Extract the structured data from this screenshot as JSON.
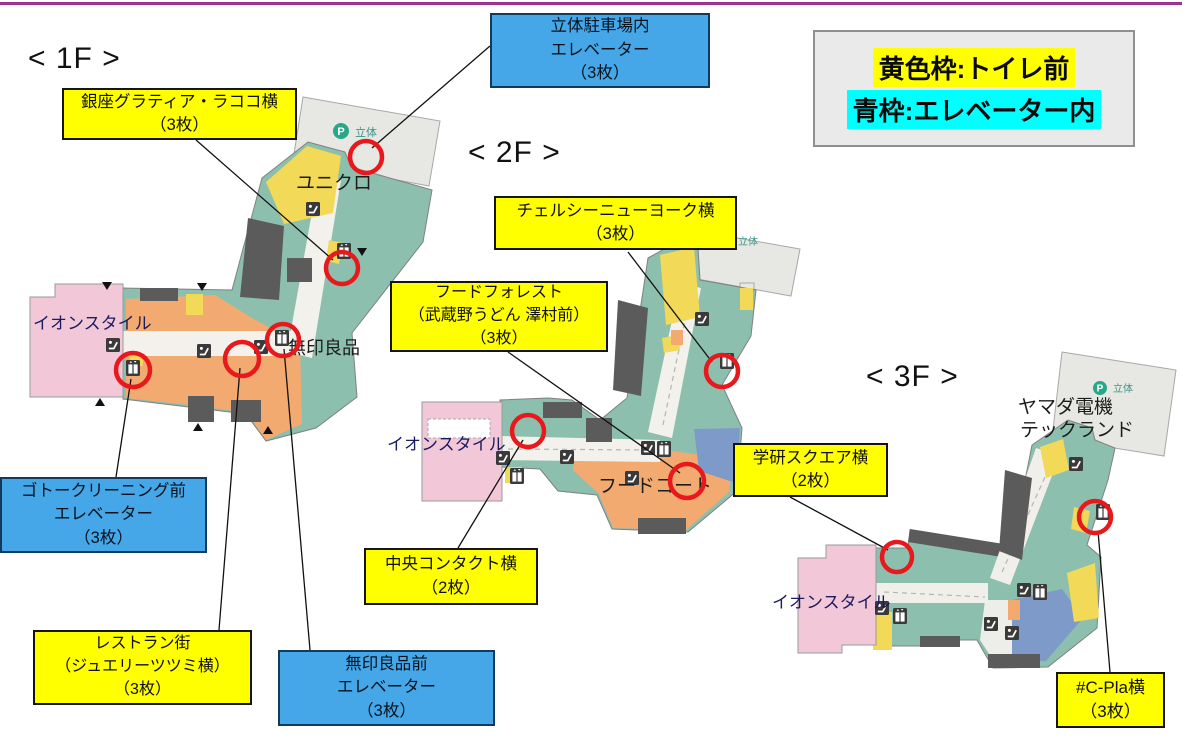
{
  "legend": {
    "line1": "黄色枠:トイレ前",
    "line2": "青枠:エレベーター内",
    "yellow": "#ffff00",
    "cyan": "#00ffff"
  },
  "floors": {
    "f1": "< 1F >",
    "f2": "< 2F >",
    "f3": "< 3F >"
  },
  "callouts": {
    "ginza": {
      "lines": [
        "銀座グラティア・ラココ横",
        "（3枚）"
      ]
    },
    "parking_ev": {
      "lines": [
        "立体駐車場内",
        "エレベーター",
        "（3枚）"
      ]
    },
    "chelsea": {
      "lines": [
        "チェルシーニューヨーク横",
        "（3枚）"
      ]
    },
    "food_forest": {
      "lines": [
        "フードフォレスト",
        "（武蔵野うどん 澤村前）",
        "（3枚）"
      ]
    },
    "gakken": {
      "lines": [
        "学研スクエア横",
        "（2枚）"
      ]
    },
    "goto": {
      "lines": [
        "ゴトークリーニング前",
        "エレベーター",
        "（3枚）"
      ]
    },
    "chuo": {
      "lines": [
        "中央コンタクト横",
        "（2枚）"
      ]
    },
    "restaurant": {
      "lines": [
        "レストラン街",
        "（ジュエリーツツミ横）",
        "（3枚）"
      ]
    },
    "muji_ev": {
      "lines": [
        "無印良品前",
        "エレベーター",
        "（3枚）"
      ]
    },
    "cpla": {
      "lines": [
        "#C-Pla横",
        "（3枚）"
      ]
    }
  },
  "map_labels": {
    "aeon_style": "イオンスタイル",
    "uniqlo": "ユニクロ",
    "muji": "無印良品",
    "food_court": "フードコート",
    "yamada_1": "ヤマダ電機",
    "yamada_2": "テックランド",
    "parking_p": "P",
    "parking": "立体"
  },
  "colors": {
    "top_bar": "#9c3390",
    "marker_red": "#e8191c",
    "callout_yellow": "#ffff00",
    "callout_blue": "#45a7e8",
    "map_teal": "#8cbfae",
    "map_orange": "#f2aa70",
    "map_yellow": "#f2d957",
    "map_pink": "#f2c8d9",
    "map_blue": "#7e9ac9",
    "map_dark": "#5b5b5b",
    "parking_gray": "#e7e7e4"
  }
}
